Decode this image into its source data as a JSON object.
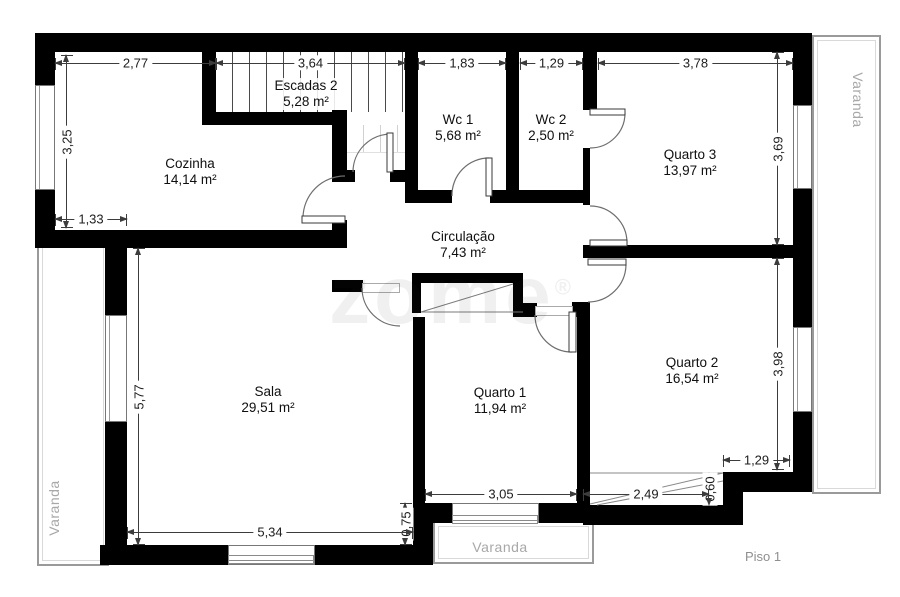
{
  "plan": {
    "floor_label": "Piso 1",
    "watermark": "zome",
    "watermark_reg": "®"
  },
  "rooms": [
    {
      "id": "cozinha",
      "name": "Cozinha",
      "area": "14,14 m²"
    },
    {
      "id": "escadas",
      "name": "Escadas 2",
      "area": "5,28 m²"
    },
    {
      "id": "wc1",
      "name": "Wc 1",
      "area": "5,68 m²"
    },
    {
      "id": "wc2",
      "name": "Wc 2",
      "area": "2,50 m²"
    },
    {
      "id": "quarto3",
      "name": "Quarto 3",
      "area": "13,97 m²"
    },
    {
      "id": "circulacao",
      "name": "Circulação",
      "area": "7,43 m²"
    },
    {
      "id": "sala",
      "name": "Sala",
      "area": "29,51 m²"
    },
    {
      "id": "quarto1",
      "name": "Quarto 1",
      "area": "11,94 m²"
    },
    {
      "id": "quarto2",
      "name": "Quarto 2",
      "area": "16,54 m²"
    }
  ],
  "balconies": {
    "right_label": "Varanda",
    "left_label": "Varanda",
    "bottom_label": "Varanda"
  },
  "dimensions": {
    "top": [
      "2,77",
      "3,64",
      "1,83",
      "1,29",
      "3,78"
    ],
    "left_vertical": [
      "3,25",
      "5,77"
    ],
    "right_vertical": [
      "3,69",
      "3,98"
    ],
    "inner": [
      "1,33",
      "0,75",
      "0,60"
    ],
    "bottom": [
      "5,34",
      "3,05",
      "2,49",
      "1,29"
    ]
  }
}
